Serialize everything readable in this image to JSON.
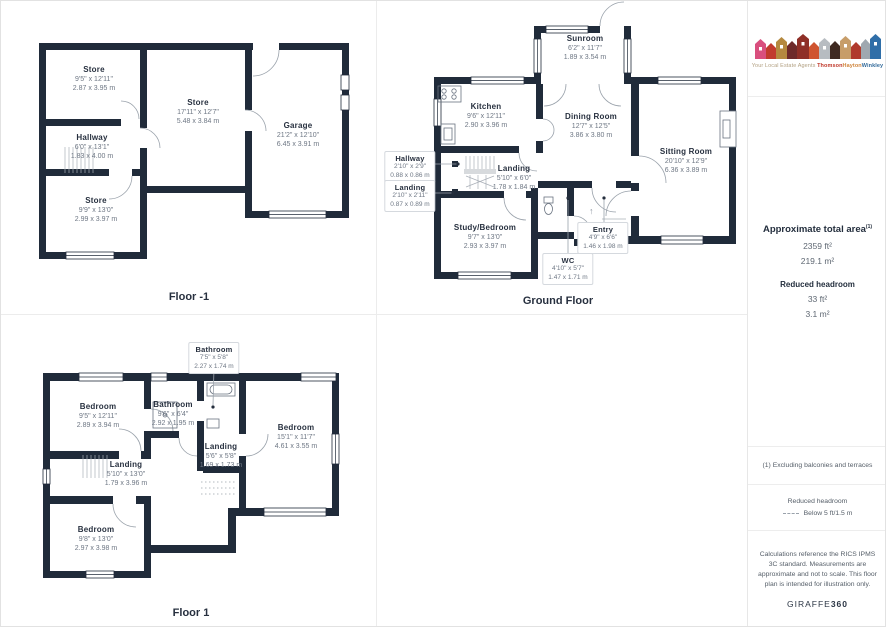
{
  "floors": {
    "floor_m1": {
      "label": "Floor -1",
      "rooms": {
        "store_top": {
          "name": "Store",
          "ft": "9'5\" x 12'11\"",
          "m": "2.87 x 3.95 m"
        },
        "store_mid": {
          "name": "Store",
          "ft": "17'11\" x 12'7\"",
          "m": "5.48 x 3.84 m"
        },
        "garage": {
          "name": "Garage",
          "ft": "21'2\" x 12'10\"",
          "m": "6.45 x 3.91 m"
        },
        "hallway": {
          "name": "Hallway",
          "ft": "6'0\" x 13'1\"",
          "m": "1.83 x 4.00 m"
        },
        "store_bottom": {
          "name": "Store",
          "ft": "9'9\" x 13'0\"",
          "m": "2.99 x 3.97 m"
        }
      }
    },
    "ground": {
      "label": "Ground Floor",
      "rooms": {
        "sunroom": {
          "name": "Sunroom",
          "ft": "6'2\" x 11'7\"",
          "m": "1.89 x 3.54 m"
        },
        "kitchen": {
          "name": "Kitchen",
          "ft": "9'6\" x 12'11\"",
          "m": "2.90 x 3.96 m"
        },
        "dining": {
          "name": "Dining Room",
          "ft": "12'7\" x 12'5\"",
          "m": "3.86 x 3.80 m"
        },
        "sitting": {
          "name": "Sitting Room",
          "ft": "20'10\" x 12'9\"",
          "m": "6.36 x 3.89 m"
        },
        "landing": {
          "name": "Landing",
          "ft": "5'10\" x 6'0\"",
          "m": "1.78 x 1.84 m"
        },
        "study_bedroom": {
          "name": "Study/Bedroom",
          "ft": "9'7\" x 13'0\"",
          "m": "2.93 x 3.97 m"
        },
        "hallway_callout": {
          "name": "Hallway",
          "ft": "2'10\" x 2'9\"",
          "m": "0.88 x 0.86 m"
        },
        "landing_callout": {
          "name": "Landing",
          "ft": "2'10\" x 2'11\"",
          "m": "0.87 x 0.89 m"
        },
        "entry_callout": {
          "name": "Entry",
          "ft": "4'9\" x 6'6\"",
          "m": "1.46 x 1.98 m"
        },
        "wc_callout": {
          "name": "WC",
          "ft": "4'10\" x 5'7\"",
          "m": "1.47 x 1.71 m"
        }
      },
      "entry_arrow_icon": "↑"
    },
    "floor1": {
      "label": "Floor 1",
      "rooms": {
        "bathroom_callout": {
          "name": "Bathroom",
          "ft": "7'5\" x 5'8\"",
          "m": "2.27 x 1.74 m"
        },
        "bedroom_tl": {
          "name": "Bedroom",
          "ft": "9'5\" x 12'11\"",
          "m": "2.89 x 3.94 m"
        },
        "bathroom": {
          "name": "Bathroom",
          "ft": "9'6\" x 6'4\"",
          "m": "2.92 x 1.95 m"
        },
        "bedroom_right": {
          "name": "Bedroom",
          "ft": "15'1\" x 11'7\"",
          "m": "4.61 x 3.55 m"
        },
        "landing_right": {
          "name": "Landing",
          "ft": "5'6\" x 5'8\"",
          "m": "1.69 x 1.73 m"
        },
        "landing_left": {
          "name": "Landing",
          "ft": "5'10\" x 13'0\"",
          "m": "1.79 x 3.96 m"
        },
        "bedroom_bottom": {
          "name": "Bedroom",
          "ft": "9'8\" x 13'0\"",
          "m": "2.97 x 3.98 m"
        }
      }
    }
  },
  "sidebar": {
    "logo": {
      "tagline": "Your Local Estate Agents",
      "brand_part1": "Thomson",
      "brand_part2": "Hayton",
      "brand_part3": "Winkley",
      "house_colors": [
        "#d94f7e",
        "#c23b2e",
        "#b5893f",
        "#6e2a2a",
        "#8f2f27",
        "#cf5430",
        "#b7bcc1",
        "#402a22",
        "#c79d69",
        "#b03a2c",
        "#9fa8b0",
        "#2f6ea8"
      ]
    },
    "area": {
      "title": "Approximate total area",
      "superscript": "(1)",
      "ft": "2359 ft²",
      "m": "219.1 m²",
      "reduced_title": "Reduced headroom",
      "reduced_ft": "33 ft²",
      "reduced_m": "3.1 m²"
    },
    "footnote": "(1) Excluding balconies and terraces",
    "legend": {
      "title": "Reduced headroom",
      "value": "Below 5 ft/1.5 m"
    },
    "disclaimer": "Calculations reference the RICS IPMS 3C standard. Measurements are approximate and not to scale. This floor plan is intended for illustration only.",
    "credit": {
      "part1": "GIRAFFE",
      "part2": "360"
    }
  },
  "colors": {
    "wall": "#202b3a",
    "brand_red": "#c0392b",
    "brand_orange": "#d0853c",
    "brand_blue": "#336b9b"
  }
}
